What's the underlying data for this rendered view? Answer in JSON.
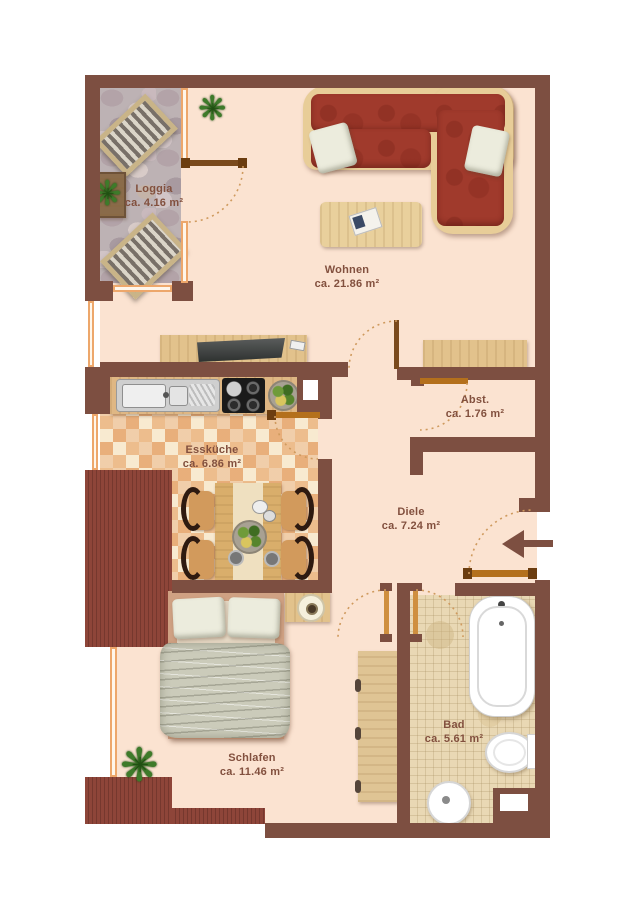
{
  "rooms": {
    "loggia": {
      "name": "Loggia",
      "area": "ca. 4.16 m²"
    },
    "wohnen": {
      "name": "Wohnen",
      "area": "ca. 21.86 m²"
    },
    "esskueche": {
      "name": "Essküche",
      "area": "ca. 6.86 m²"
    },
    "abstellraum": {
      "name": "Abst.",
      "area": "ca. 1.76 m²"
    },
    "diele": {
      "name": "Diele",
      "area": "ca. 7.24 m²"
    },
    "schlafen": {
      "name": "Schlafen",
      "area": "ca. 11.46 m²"
    },
    "bad": {
      "name": "Bad",
      "area": "ca. 5.61 m²"
    }
  },
  "colors": {
    "wall": "#7d4f41",
    "floor": "#fbe3d1",
    "label_text": "#82503e",
    "door": "#b4701c",
    "window": "#eda76b",
    "sofa": "#a03a2c",
    "hatch": "#8e4539"
  },
  "icons": [
    "entrance-arrow-icon",
    "plant-icon",
    "sofa",
    "coffee-table",
    "tv-sideboard",
    "sideboard",
    "kitchen-counter",
    "kitchen-sink",
    "cooktop",
    "fruit-bowl",
    "dining-table",
    "dining-chair",
    "deck-chair",
    "loggia-table",
    "bed",
    "pillow",
    "blanket",
    "nightstand",
    "lamp",
    "wardrobe",
    "bathtub",
    "toilet",
    "wash-basin",
    "door-swing-arc",
    "magazine",
    "tv",
    "remote"
  ]
}
